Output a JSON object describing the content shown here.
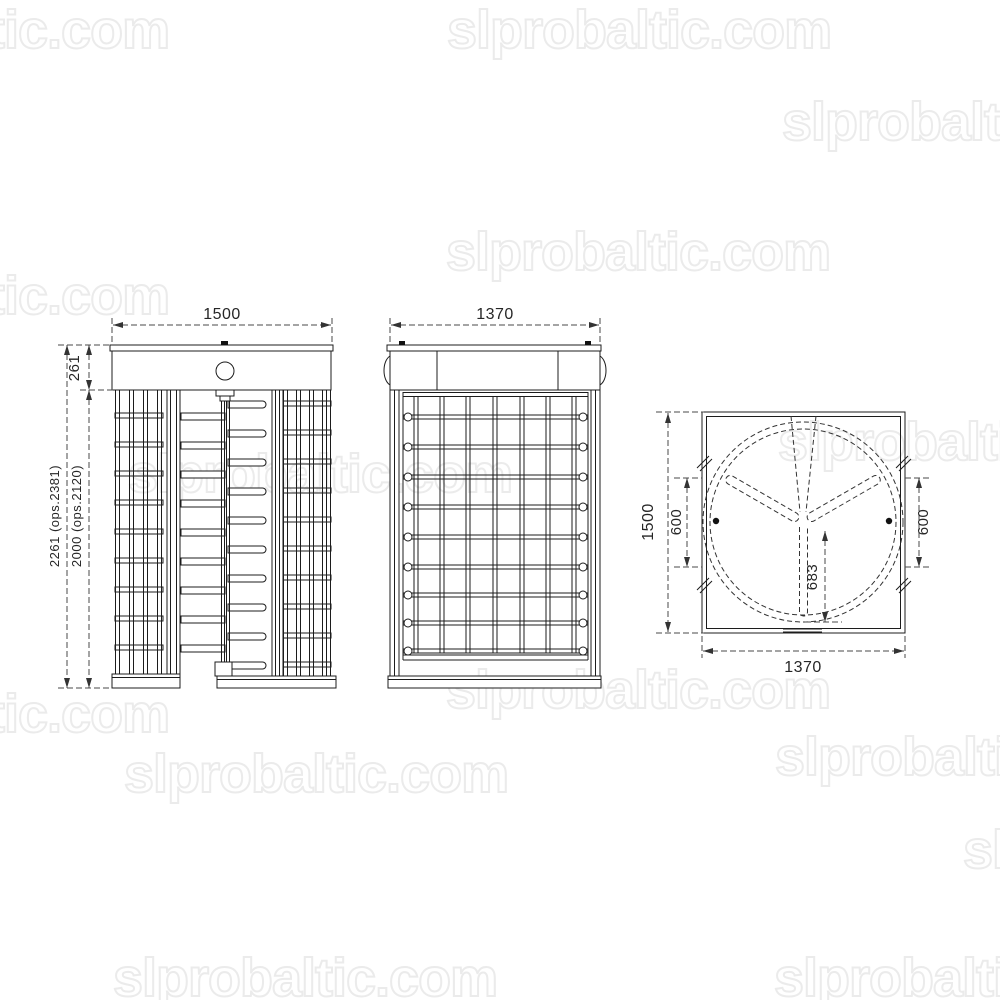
{
  "watermark": {
    "text": "slprobaltic.com",
    "color": "#ebebeb"
  },
  "drawing": {
    "type": "technical-drawing",
    "subject": "full-height turnstile, three orthographic views",
    "views": [
      "front view",
      "side view",
      "plan view"
    ]
  },
  "dimensions": {
    "front_width": "1500",
    "front_header_height": "261",
    "front_total_height": "2261 (ops.2381)",
    "front_inner_height": "2000 (ops.2120)",
    "side_width": "1370",
    "plan_height": "1500",
    "plan_width": "1370",
    "plan_passage_left": "600",
    "plan_passage_right": "600",
    "plan_rotor_offset": "683"
  }
}
